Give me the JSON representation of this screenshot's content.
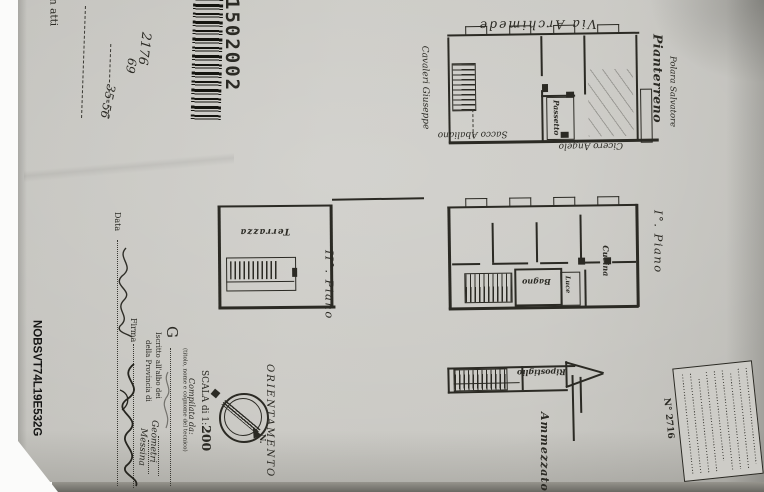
{
  "doc": {
    "in_atti": "n atti",
    "barcode_number": "1502002",
    "ref_a": "2176",
    "ref_b": "69",
    "ref_c": "35-56",
    "photo_code": "NOBSVT74L19E532G"
  },
  "street": {
    "label": "Via Archimede"
  },
  "ground": {
    "title": "Pianterreno",
    "neighbor_left": "Cavaleri Giuseppe",
    "neighbor_bottom": "Sacco Abaliano",
    "neighbor_corner": "Cicero Angelo",
    "neighbor_right": "Polara Salvatore",
    "passetto": "Passetto"
  },
  "first": {
    "title": "I°. Piano",
    "bagno": "Bagno",
    "luce": "Luce",
    "cucina": "Cucina"
  },
  "second": {
    "title": "II°. Piano",
    "terrazza": "Terrazza"
  },
  "mezzanine": {
    "title": "Ammezzato",
    "ripostiglio": "Ripostiglio"
  },
  "orientation": {
    "label": "ORIENTAMENTO",
    "north": "N."
  },
  "scale": {
    "prefix": "SCALA di 1:",
    "value": "200"
  },
  "form": {
    "compiled_by": "Compilata da:",
    "tech_initial": "G",
    "tech_caption": "(titolo, nome e cognome del tecnico)",
    "albo_label": "Iscritto all'albo dei",
    "albo_entry": "Geometri",
    "provincia_label": "della Provincia di",
    "provincia_entry": "Messina",
    "date_label": "Data",
    "signature_label": "Firma"
  },
  "stamp": {
    "number": "N° 2716"
  }
}
